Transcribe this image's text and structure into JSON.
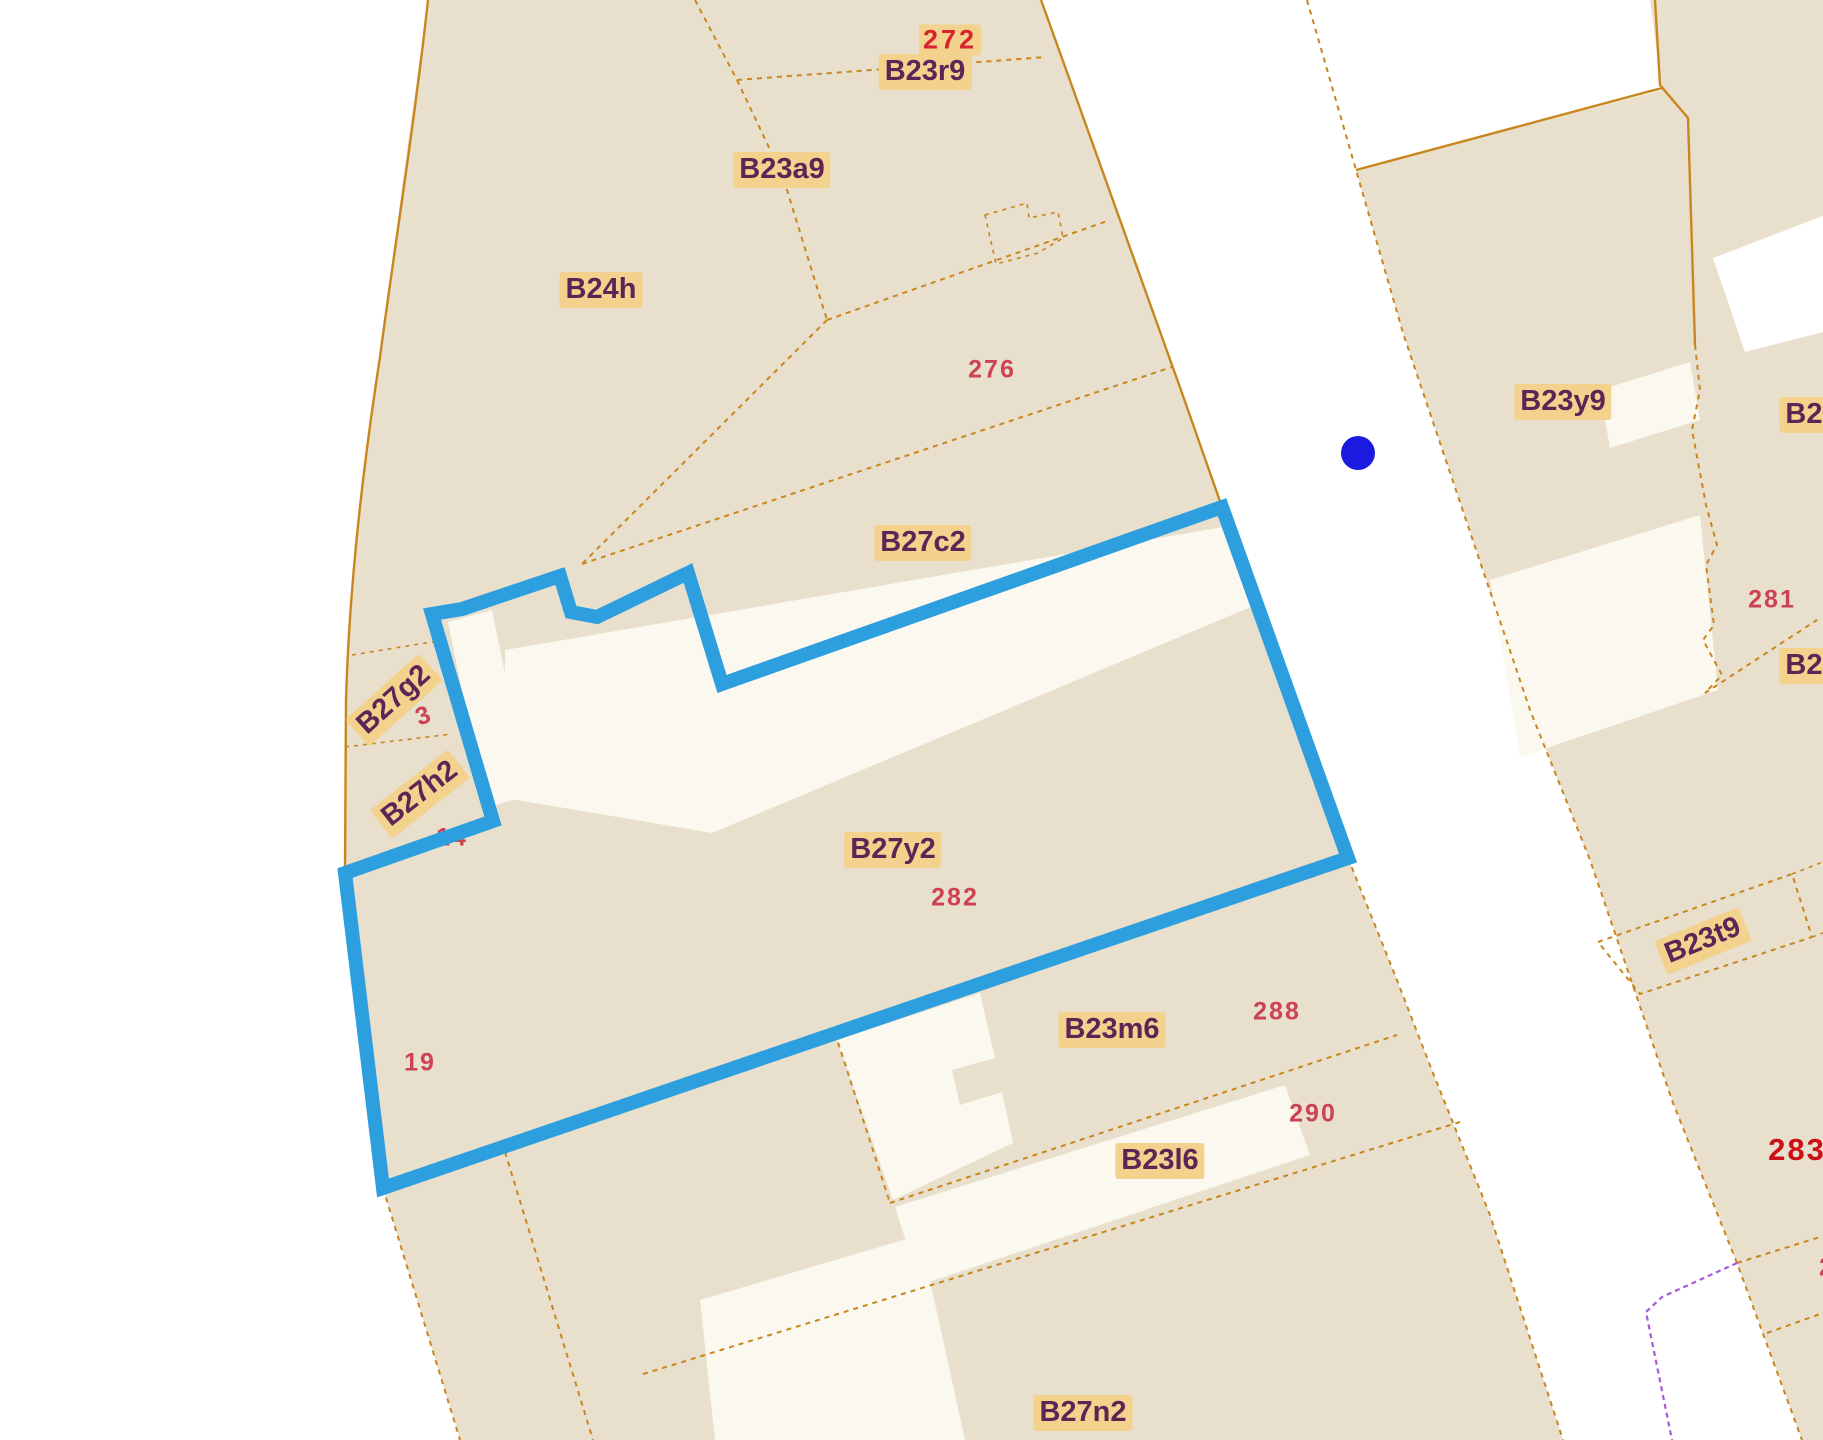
{
  "app": {
    "view": "cadastral-parcel-map",
    "selected_parcel": "B27y2",
    "selected_parcel_number": "282"
  },
  "colors": {
    "background_beige": "#e9dfcd",
    "road_white": "#ffffff",
    "building_cream": "#fbf8f0",
    "parcel_line_gold": "#c8871e",
    "selection_blue": "#2d9ede",
    "marker_blue": "#1b1be0",
    "label_plum": "#5e2456",
    "label_cream_bg": "#f2d28c",
    "number_red": "#cd4250",
    "number_bright_red": "#d8232f",
    "number_dark_red": "#cc1016",
    "boundary_violet": "#a55ad8"
  },
  "map": {
    "marker": {
      "name": "blue-location-dot",
      "x": 1358,
      "y": 453
    },
    "labels": [
      {
        "text": "272",
        "type": "num-bold",
        "x": 950,
        "y": 40,
        "rot": 0
      },
      {
        "text": "B23r9",
        "type": "parcel",
        "x": 925,
        "y": 72,
        "rot": 0
      },
      {
        "text": "B23a9",
        "type": "parcel",
        "x": 782,
        "y": 170,
        "rot": 0
      },
      {
        "text": "B24h",
        "type": "parcel",
        "x": 601,
        "y": 290,
        "rot": 0
      },
      {
        "text": "276",
        "type": "num",
        "x": 992,
        "y": 370,
        "rot": 0
      },
      {
        "text": "B27c2",
        "type": "parcel",
        "x": 923,
        "y": 543,
        "rot": 0
      },
      {
        "text": "B27g2",
        "type": "parcel",
        "x": 394,
        "y": 700,
        "rot": -42
      },
      {
        "text": "3",
        "type": "num",
        "x": 424,
        "y": 716,
        "rot": -20
      },
      {
        "text": "B27h2",
        "type": "parcel",
        "x": 420,
        "y": 794,
        "rot": -38
      },
      {
        "text": "14",
        "type": "num",
        "x": 452,
        "y": 838,
        "rot": 0
      },
      {
        "text": "B27y2",
        "type": "parcel",
        "x": 893,
        "y": 850,
        "rot": 0
      },
      {
        "text": "282",
        "type": "num",
        "x": 955,
        "y": 898,
        "rot": 0
      },
      {
        "text": "19",
        "type": "num",
        "x": 420,
        "y": 1063,
        "rot": 0
      },
      {
        "text": "B23m6",
        "type": "parcel",
        "x": 1112,
        "y": 1030,
        "rot": 0
      },
      {
        "text": "288",
        "type": "num",
        "x": 1277,
        "y": 1012,
        "rot": 0
      },
      {
        "text": "290",
        "type": "num",
        "x": 1313,
        "y": 1114,
        "rot": 0
      },
      {
        "text": "B23l6",
        "type": "parcel",
        "x": 1160,
        "y": 1161,
        "rot": 0
      },
      {
        "text": "B27n2",
        "type": "parcel",
        "x": 1083,
        "y": 1413,
        "rot": 0
      },
      {
        "text": "B23y9",
        "type": "parcel",
        "x": 1563,
        "y": 402,
        "rot": 0
      },
      {
        "text": "B23",
        "type": "parcel",
        "x": 1812,
        "y": 415,
        "rot": 0
      },
      {
        "text": "281",
        "type": "num",
        "x": 1772,
        "y": 600,
        "rot": 0
      },
      {
        "text": "B23",
        "type": "parcel",
        "x": 1812,
        "y": 666,
        "rot": 0
      },
      {
        "text": "B23t9",
        "type": "parcel",
        "x": 1703,
        "y": 941,
        "rot": -22
      },
      {
        "text": "283",
        "type": "num-big",
        "x": 1797,
        "y": 1150,
        "rot": 0
      },
      {
        "text": "2",
        "type": "num",
        "x": 1827,
        "y": 1268,
        "rot": 0
      }
    ]
  }
}
